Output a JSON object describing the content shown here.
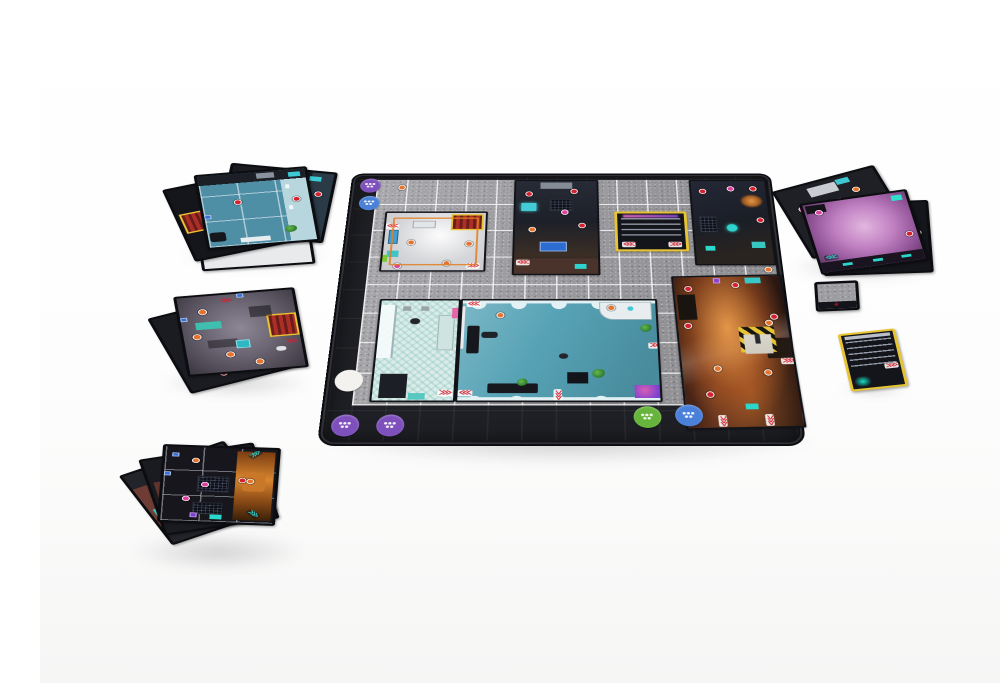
{
  "image": {
    "kind": "product-photograph",
    "subject": "Sci-fi modular board game laid out on a white table: dark grid play mat with placed room tiles, round plastic-look player tokens, and piles of unused square room tiles around the mat",
    "background_color": "#ffffff"
  },
  "colors": {
    "mat-surface": "#9e9ea2",
    "mat-band": "#26262b",
    "lab-floor": "#c6c7ca",
    "shower-tile": "#dcece8",
    "pool-water": "#57a3b6",
    "pool-deck": "#e2f1f3",
    "door-red": "#ab2f26",
    "door-yellow": "#e7c434",
    "hazard-core": "#cfccc2",
    "accent-teal": "#2fd2cc",
    "accent-orange": "#e5732e",
    "accent-magenta": "#dd3f9e",
    "accent-red": "#d5202e",
    "token-purple": "#7e50bc",
    "token-blue": "#4a80d8",
    "token-green": "#66b43c",
    "token-white": "#f4f2ee"
  },
  "icons": {
    "chevrons_left": "⋘",
    "chevrons_right": "⋙",
    "spark": "✳"
  },
  "mat": {
    "grid_columns": 13,
    "grid_rows": 8,
    "tokens": [
      {
        "id": "purple-top",
        "color": "#7e50bc"
      },
      {
        "id": "blue-top",
        "color": "#4a80d8"
      },
      {
        "id": "white-corner",
        "color": "#f4f2ee"
      },
      {
        "id": "purple-bottom-1",
        "color": "#7e50bc"
      },
      {
        "id": "purple-bottom-2",
        "color": "#7e50bc"
      },
      {
        "id": "green-bottom",
        "color": "#66b43c"
      },
      {
        "id": "blue-bottom",
        "color": "#4a80d8"
      }
    ],
    "placed_tiles": [
      "foggy-lab-room-with-red-door",
      "dark-machine-room",
      "elevator-shaft-tile",
      "dark-corner-room",
      "tiled-shower-room",
      "pool-lounge-room-with-bar",
      "burning-industrial-room-with-hazard-square"
    ],
    "alarm_icon_count": 3
  },
  "loose_piles": {
    "top_left_stack": {
      "tile_count": 4,
      "top_tile": "blue-pool-room"
    },
    "middle_left_stack": {
      "tile_count": 2,
      "top_tile": "violet-corridor-room-with-red-door"
    },
    "bottom_left_stack": {
      "tile_count": 3,
      "top_tile": "dark-room-with-burning-car"
    },
    "right_fan": {
      "tile_count": 3,
      "top_tile": "pink-dance-floor-room"
    },
    "small_square_tile": {
      "tile_count": 1,
      "top_tile": "gray-floor-tile"
    },
    "loose_elevator_tile": {
      "tile_count": 1,
      "top_tile": "yellow-framed-elevator"
    }
  }
}
